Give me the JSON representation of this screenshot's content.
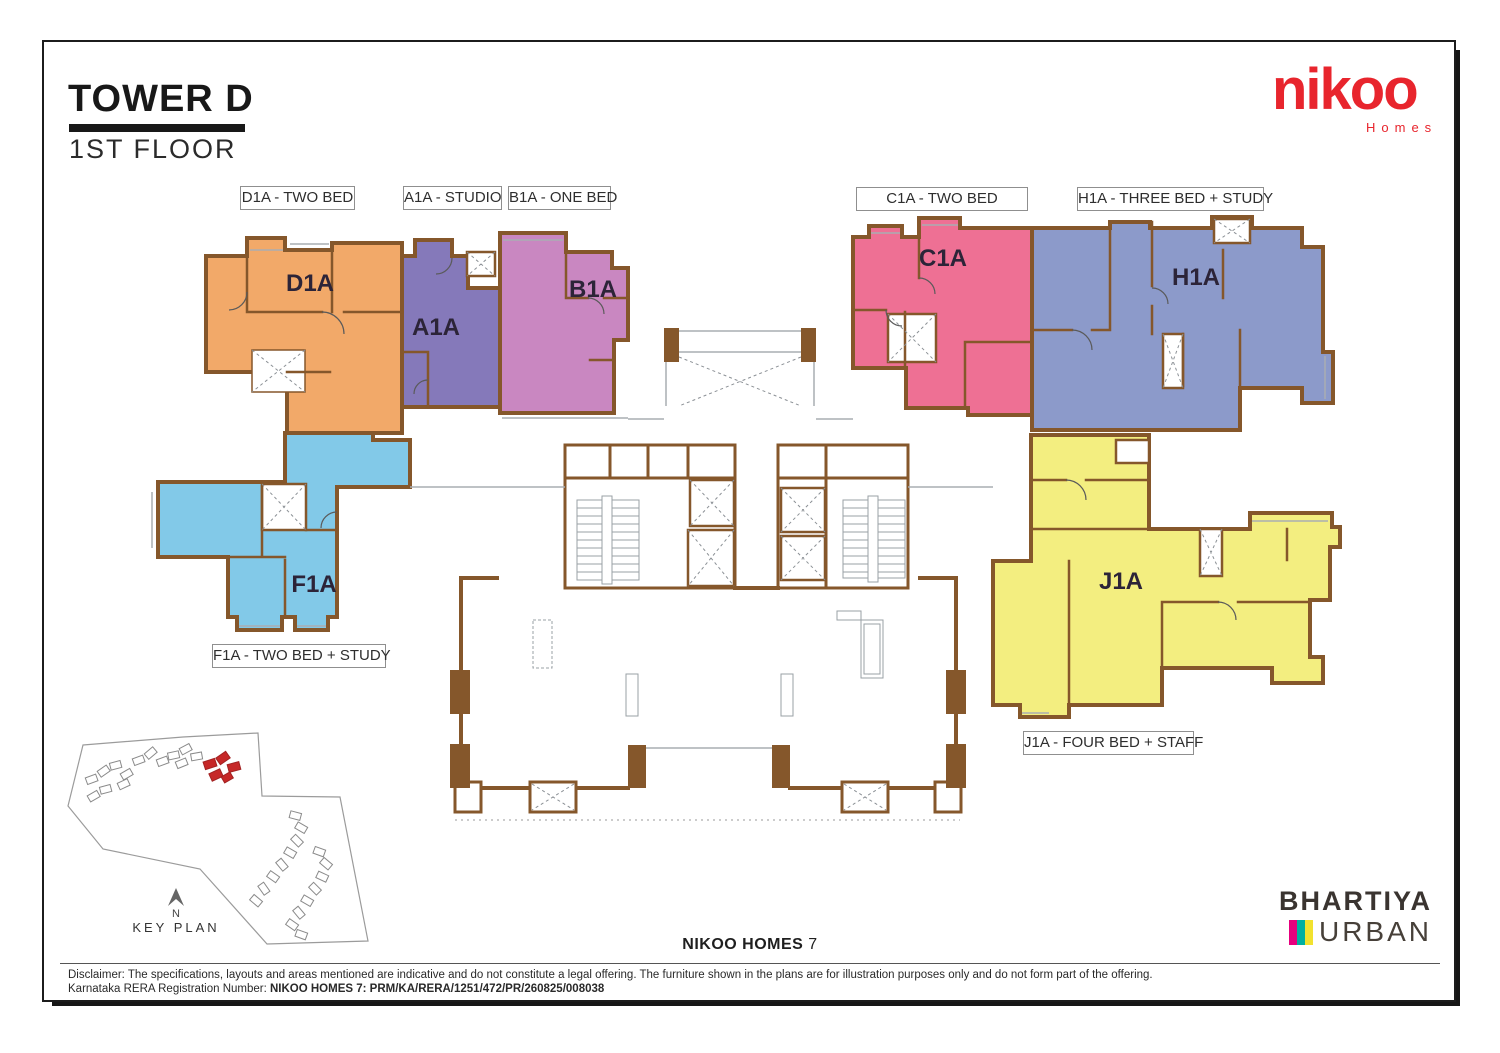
{
  "page": {
    "title": "TOWER D",
    "subtitle": "1ST FLOOR"
  },
  "brand": {
    "logo_text": "nikoo",
    "logo_sub": "Homes",
    "developer_name": "BHARTIYA",
    "developer_sub": "URBAN",
    "mark_colors": [
      "#e6007e",
      "#00b0a0",
      "#f2e22e"
    ]
  },
  "units": [
    {
      "id": "D1A",
      "type_label": "D1A - TWO BED",
      "color": "#f2a969"
    },
    {
      "id": "A1A",
      "type_label": "A1A - STUDIO",
      "color": "#8579ba"
    },
    {
      "id": "B1A",
      "type_label": "B1A - ONE BED",
      "color": "#c987c1"
    },
    {
      "id": "C1A",
      "type_label": "C1A - TWO BED",
      "color": "#ee7094"
    },
    {
      "id": "H1A",
      "type_label": "H1A - THREE BED + STUDY",
      "color": "#8c9aca"
    },
    {
      "id": "F1A",
      "type_label": "F1A - TWO BED + STUDY",
      "color": "#82c9e8"
    },
    {
      "id": "J1A",
      "type_label": "J1A - FOUR BED + STAFF",
      "color": "#f3ee80"
    }
  ],
  "key_plan": {
    "label": "KEY PLAN",
    "north_label": "N",
    "highlight_color": "#c62828"
  },
  "footer": {
    "project_bold": "NIKOO HOMES",
    "project_number": "7"
  },
  "disclaimer": {
    "line1": "Disclaimer: The specifications, layouts and areas mentioned are indicative and do not constitute a legal offering. The furniture shown in the plans are for illustration purposes only and do not form part of the offering.",
    "line2_prefix": "Karnataka RERA Registration Number: ",
    "line2_value": "NIKOO HOMES 7: PRM/KA/RERA/1251/472/PR/260825/008038"
  },
  "colors": {
    "wall": "#85572b"
  }
}
